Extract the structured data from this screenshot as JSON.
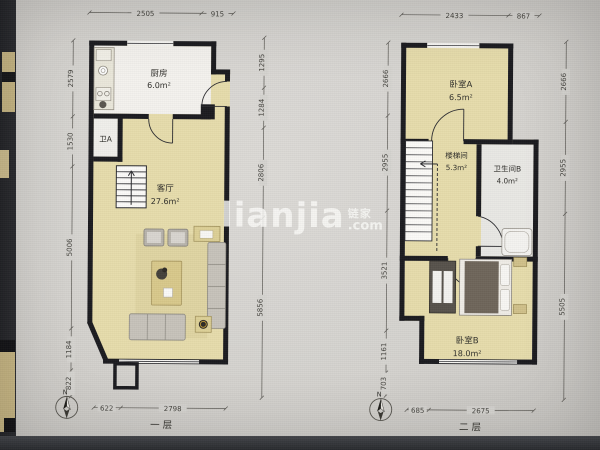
{
  "watermark": {
    "brand": "lianjia",
    "cn": "链家",
    "com": ".com"
  },
  "floor1": {
    "label": "一层",
    "compass_n": "N",
    "rooms": {
      "kitchen": {
        "name": "厨房",
        "area": "6.0m²"
      },
      "bath_a": {
        "name": "卫A"
      },
      "living": {
        "name": "客厅",
        "area": "27.6m²"
      }
    },
    "dims": {
      "top": [
        "2505",
        "915"
      ],
      "left": [
        "2579",
        "1530",
        "5006",
        "1184",
        "822"
      ],
      "right": [
        "1295",
        "1284",
        "2806",
        "5856"
      ],
      "bottom": [
        "622",
        "2798"
      ]
    }
  },
  "floor2": {
    "label": "二层",
    "compass_n": "N",
    "rooms": {
      "bed_a": {
        "name": "卧室A",
        "area": "6.5m²"
      },
      "stair": {
        "name": "楼梯间",
        "area": "5.3m²"
      },
      "bath_b": {
        "name": "卫生间B",
        "area": "4.0m²"
      },
      "bed_b": {
        "name": "卧室B",
        "area": "18.0m²"
      }
    },
    "dims": {
      "top": [
        "2433",
        "867"
      ],
      "left": [
        "2666",
        "2955",
        "3521",
        "1161",
        "703"
      ],
      "right": [
        "2666",
        "2955",
        "5505"
      ],
      "bottom": [
        "685",
        "2675"
      ]
    }
  }
}
